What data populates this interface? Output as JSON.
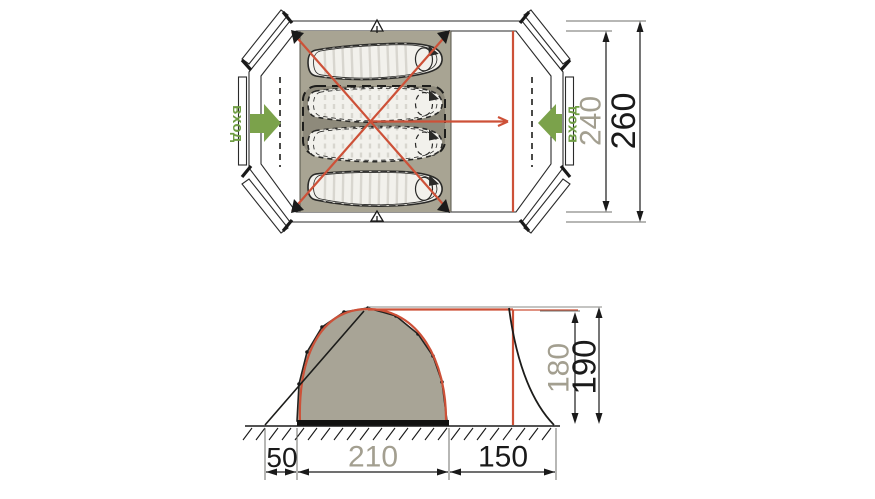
{
  "labels": {
    "entrance_left": "вход",
    "entrance_right": "вход",
    "width_inner": "240",
    "width_outer": "260",
    "height_inner": "180",
    "height_outer": "190",
    "offset_left": "50",
    "length_sleeping": "210",
    "length_vestibule": "150"
  },
  "colors": {
    "frame_red": "#cd5138",
    "entrance_green": "#6f9d43",
    "floor_olive": "#a8a493",
    "inner_tent_olive": "#8e8a7b",
    "dimension_gray": "#a39f90",
    "ink": "#1a1a1a"
  }
}
